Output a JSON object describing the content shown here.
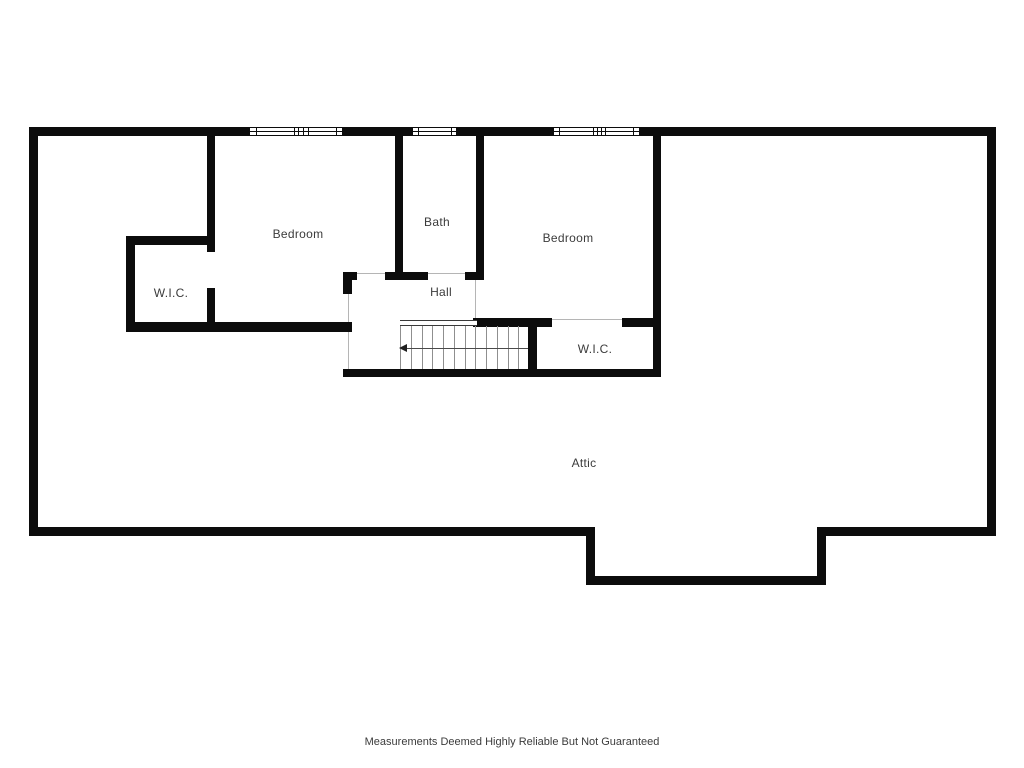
{
  "floor_plan": {
    "rooms": {
      "bedroom_left": "Bedroom",
      "bath": "Bath",
      "bedroom_right": "Bedroom",
      "wic_left": "W.I.C.",
      "hall": "Hall",
      "wic_right": "W.I.C.",
      "attic": "Attic"
    },
    "stairs": {
      "tread_count": 12,
      "direction_arrow": "left"
    },
    "windows": {
      "count": 3,
      "panes": [
        2,
        1,
        2
      ]
    },
    "disclaimer": "Measurements Deemed Highly Reliable But Not Guaranteed",
    "colors": {
      "wall": "#0c0c0c",
      "label_text": "#3b3b3b",
      "tread_line": "#8f8f8f",
      "opening_line": "#b5b5b5"
    }
  }
}
